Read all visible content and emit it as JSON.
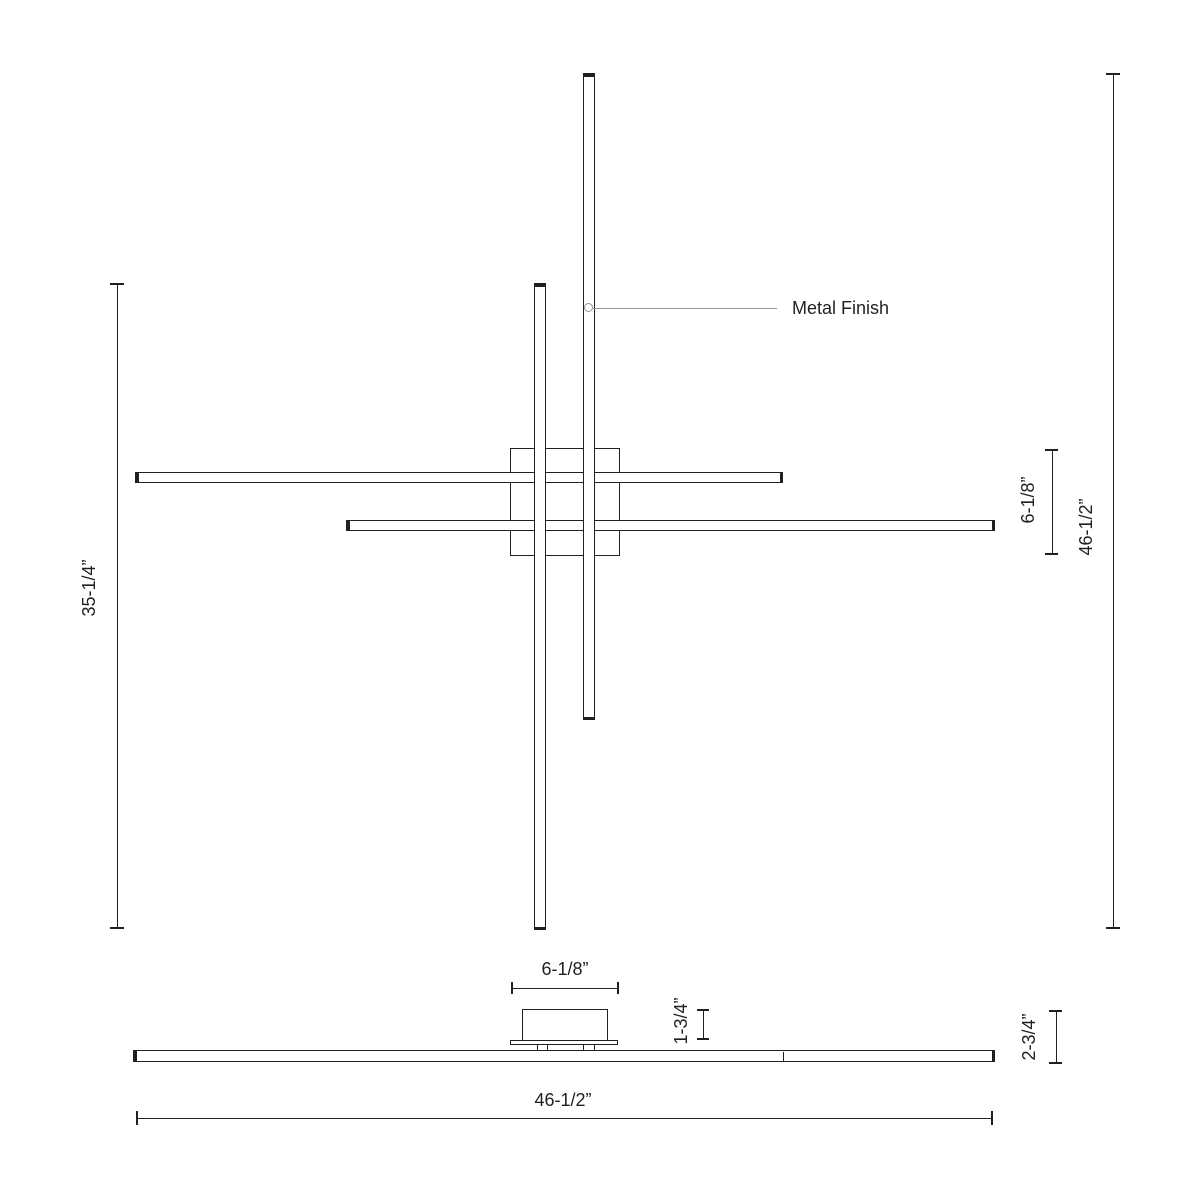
{
  "colors": {
    "line": "#231f20",
    "leader": "#939598",
    "background": "#ffffff"
  },
  "plan_view": {
    "callout_label": "Metal Finish",
    "dim_bar_length": "35-1/4”",
    "dim_overall_height": "46-1/2”",
    "dim_canopy": "6-1/8”"
  },
  "elevation_view": {
    "dim_canopy_width": "6-1/8”",
    "dim_canopy_height": "1-3/4”",
    "dim_overall_height": "2-3/4”",
    "dim_overall_width": "46-1/2”"
  }
}
